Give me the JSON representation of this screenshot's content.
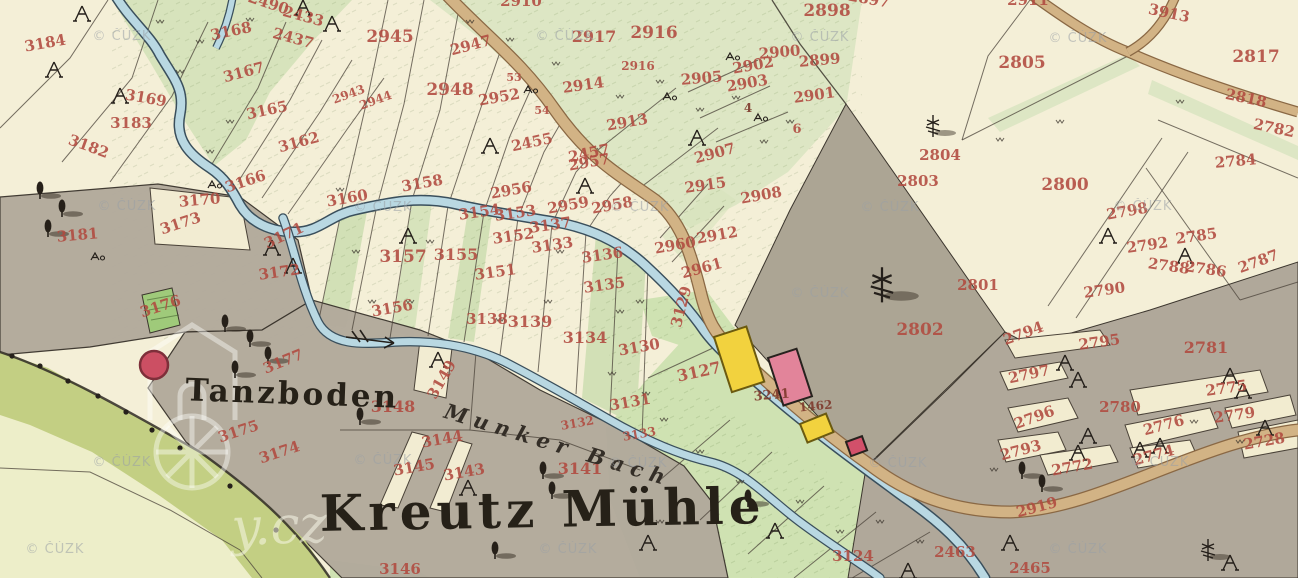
{
  "map": {
    "type": "historical-cadastral-map",
    "place_labels": {
      "settlement": "Kreutz Mühle",
      "area": "Tanzboden",
      "stream": "Munker Bach"
    },
    "watermark_text": "© ČÚZK",
    "watermark_big_text": "y.cz",
    "palette": {
      "paper": "#f4efd7",
      "field_green": "#d7e3bc",
      "meadow_olive": "#c3cf83",
      "pasture_gray": "#b2aa9c",
      "water_fill": "#b9d8e2",
      "water_edge": "#3a4f5c",
      "road_fill": "#d2b385",
      "road_edge": "#8a6844",
      "parcel_number_red": "#b14a3f",
      "building_wood_yellow": "#f2d23e",
      "building_masonry_pink": "#e2849a",
      "building_red": "#d2506a",
      "label_black": "#262118"
    },
    "parcel_numbers": [
      [
        "3184",
        46,
        48,
        -10
      ],
      [
        "3183",
        131,
        128,
        0
      ],
      [
        "3182",
        87,
        151,
        20
      ],
      [
        "3169",
        145,
        103,
        10
      ],
      [
        "3168",
        232,
        36,
        -12
      ],
      [
        "3167",
        245,
        77,
        -15
      ],
      [
        "3165",
        268,
        115,
        -12
      ],
      [
        "3162",
        300,
        147,
        -15
      ],
      [
        "3166",
        247,
        186,
        -18
      ],
      [
        "3170",
        200,
        205,
        -5
      ],
      [
        "3173",
        182,
        228,
        -18
      ],
      [
        "3181",
        78,
        240,
        -5
      ],
      [
        "3171",
        286,
        240,
        -25
      ],
      [
        "3172",
        280,
        277,
        -8
      ],
      [
        "3176",
        162,
        311,
        -18
      ],
      [
        "3177",
        285,
        366,
        -22
      ],
      [
        "3175",
        240,
        436,
        -18
      ],
      [
        "3174",
        281,
        457,
        -18
      ],
      [
        "2490",
        267,
        8,
        18
      ],
      [
        "2433",
        302,
        21,
        15
      ],
      [
        "2437",
        292,
        43,
        15
      ],
      [
        "2945",
        390,
        42,
        0,
        17
      ],
      [
        "2947",
        472,
        50,
        -15
      ],
      [
        "2948",
        450,
        95,
        0,
        17
      ],
      [
        "2952",
        500,
        102,
        -10
      ],
      [
        "53",
        514,
        81,
        0,
        11
      ],
      [
        "54",
        542,
        114,
        0,
        11
      ],
      [
        "2943",
        350,
        98,
        -20,
        12
      ],
      [
        "2944",
        377,
        104,
        -20,
        12
      ],
      [
        "2455",
        533,
        147,
        -12
      ],
      [
        "2457",
        590,
        158,
        -12
      ],
      [
        "2910",
        521,
        6,
        0
      ],
      [
        "2914",
        584,
        90,
        -8
      ],
      [
        "2913",
        628,
        127,
        -10
      ],
      [
        "2916",
        654,
        38,
        0,
        17
      ],
      [
        "2916",
        638,
        70,
        0,
        12
      ],
      [
        "2917",
        594,
        42,
        0,
        16
      ],
      [
        "2898",
        827,
        16,
        0,
        17
      ],
      [
        "2899",
        820,
        65,
        -5
      ],
      [
        "2900",
        780,
        57,
        -5
      ],
      [
        "2901",
        815,
        100,
        -8
      ],
      [
        "2902",
        754,
        70,
        -10
      ],
      [
        "2903",
        748,
        88,
        -10
      ],
      [
        "2905",
        702,
        83,
        -5
      ],
      [
        "2897",
        868,
        4,
        10
      ],
      [
        "2907",
        716,
        158,
        -15
      ],
      [
        "2915",
        706,
        190,
        -8
      ],
      [
        "2908",
        762,
        200,
        -10
      ],
      [
        "2912",
        718,
        240,
        -10
      ],
      [
        "2960",
        676,
        250,
        -10
      ],
      [
        "2961",
        703,
        273,
        -15
      ],
      [
        "6",
        797,
        133,
        0,
        13
      ],
      [
        "2957",
        590,
        167,
        -10
      ],
      [
        "2956",
        512,
        195,
        -10
      ],
      [
        "2959",
        569,
        210,
        -10
      ],
      [
        "2958",
        613,
        210,
        -10
      ],
      [
        "3160",
        348,
        203,
        -10
      ],
      [
        "3158",
        423,
        188,
        -10
      ],
      [
        "3157",
        403,
        262,
        0,
        17
      ],
      [
        "3155",
        456,
        260,
        0,
        16
      ],
      [
        "3154",
        480,
        217,
        -8
      ],
      [
        "3153",
        516,
        218,
        -8
      ],
      [
        "3152",
        514,
        241,
        -8
      ],
      [
        "3151",
        496,
        277,
        -8
      ],
      [
        "3137",
        551,
        230,
        -8
      ],
      [
        "3133",
        553,
        250,
        -8
      ],
      [
        "3136",
        603,
        260,
        -8
      ],
      [
        "3135",
        605,
        290,
        -8
      ],
      [
        "3156",
        393,
        313,
        -10
      ],
      [
        "3138",
        487,
        324,
        0
      ],
      [
        "3139",
        530,
        327,
        0,
        16
      ],
      [
        "3134",
        585,
        343,
        0,
        16
      ],
      [
        "3130",
        640,
        352,
        -10
      ],
      [
        "3131",
        631,
        407,
        -10
      ],
      [
        "3132",
        578,
        427,
        -10,
        12
      ],
      [
        "3133",
        640,
        438,
        -10,
        12
      ],
      [
        "3129",
        686,
        308,
        -75
      ],
      [
        "3127",
        700,
        377,
        -12,
        16
      ],
      [
        "3149",
        446,
        382,
        -60
      ],
      [
        "3144",
        443,
        444,
        -10
      ],
      [
        "3145",
        415,
        472,
        -10
      ],
      [
        "3143",
        465,
        477,
        -10
      ],
      [
        "3141",
        580,
        474,
        0,
        16
      ],
      [
        "3148",
        393,
        412,
        0,
        16
      ],
      [
        "3146",
        400,
        574,
        0
      ],
      [
        "3124",
        853,
        561,
        0
      ],
      [
        "2463",
        955,
        557,
        0
      ],
      [
        "2465",
        1030,
        573,
        0
      ],
      [
        "2919",
        1038,
        512,
        -15
      ],
      [
        "2804",
        940,
        160,
        0
      ],
      [
        "2803",
        918,
        186,
        0
      ],
      [
        "2800",
        1065,
        190,
        0,
        17
      ],
      [
        "2801",
        978,
        290,
        0
      ],
      [
        "2802",
        920,
        335,
        0,
        17
      ],
      [
        "2805",
        1022,
        68,
        0,
        17
      ],
      [
        "3913",
        1168,
        18,
        12
      ],
      [
        "2911",
        1028,
        5,
        0
      ],
      [
        "2817",
        1256,
        62,
        0,
        17
      ],
      [
        "2818",
        1245,
        103,
        12
      ],
      [
        "2782",
        1273,
        133,
        12
      ],
      [
        "2784",
        1236,
        166,
        -5
      ],
      [
        "2798",
        1128,
        216,
        -10
      ],
      [
        "2792",
        1148,
        250,
        -8
      ],
      [
        "2785",
        1197,
        241,
        -8
      ],
      [
        "2788",
        1168,
        271,
        8
      ],
      [
        "2786",
        1205,
        274,
        8
      ],
      [
        "2787",
        1260,
        266,
        -20
      ],
      [
        "2790",
        1105,
        295,
        -8
      ],
      [
        "2781",
        1206,
        353,
        0,
        16
      ],
      [
        "2794",
        1025,
        338,
        -20
      ],
      [
        "2795",
        1100,
        347,
        -8
      ],
      [
        "2797",
        1030,
        379,
        -12
      ],
      [
        "2796",
        1036,
        422,
        -20
      ],
      [
        "2793",
        1022,
        455,
        -15
      ],
      [
        "2780",
        1120,
        412,
        0
      ],
      [
        "2775",
        1227,
        393,
        -8
      ],
      [
        "2776",
        1165,
        430,
        -15
      ],
      [
        "2779",
        1235,
        420,
        -8
      ],
      [
        "2728",
        1265,
        446,
        -10
      ],
      [
        "2772",
        1073,
        472,
        -10
      ],
      [
        "2774",
        1155,
        460,
        -15
      ]
    ],
    "house_numbers": [
      [
        "3241",
        772,
        399,
        -5,
        13
      ],
      [
        "1462",
        816,
        410,
        -5,
        12
      ],
      [
        "4",
        748,
        112,
        0,
        12
      ]
    ],
    "watermarks": [
      [
        122,
        40
      ],
      [
        565,
        40
      ],
      [
        820,
        41
      ],
      [
        1078,
        42
      ],
      [
        127,
        210
      ],
      [
        383,
        211
      ],
      [
        640,
        211
      ],
      [
        890,
        211
      ],
      [
        1143,
        210
      ],
      [
        820,
        297
      ],
      [
        122,
        466
      ],
      [
        383,
        464
      ],
      [
        638,
        467
      ],
      [
        898,
        467
      ],
      [
        1160,
        466
      ],
      [
        55,
        553
      ],
      [
        568,
        553
      ],
      [
        1078,
        553
      ]
    ],
    "buildings": [
      {
        "kind": "wood",
        "color": "#f2d23e",
        "outline": "#6b5a10",
        "x": 714,
        "y": 337,
        "w": 34,
        "h": 58,
        "rot": -18
      },
      {
        "kind": "masonry",
        "color": "#e2849a",
        "outline": "#27221e",
        "x": 768,
        "y": 358,
        "w": 30,
        "h": 50,
        "rot": -18
      },
      {
        "kind": "wood",
        "color": "#f2d23e",
        "outline": "#6b5a10",
        "x": 800,
        "y": 424,
        "w": 28,
        "h": 20,
        "rot": -22
      },
      {
        "kind": "masonry",
        "color": "#d2506a",
        "outline": "#27221e",
        "x": 846,
        "y": 442,
        "w": 17,
        "h": 15,
        "rot": -20
      }
    ],
    "dance_circle": {
      "cx": 154,
      "cy": 365,
      "r": 14,
      "color": "#cc4f63",
      "outline": "#7e2f3a"
    },
    "symbols": {
      "tents": [
        [
          82,
          16
        ],
        [
          54,
          72
        ],
        [
          120,
          98
        ],
        [
          303,
          10
        ],
        [
          332,
          26
        ],
        [
          272,
          250
        ],
        [
          293,
          268
        ],
        [
          408,
          238
        ],
        [
          490,
          148
        ],
        [
          585,
          188
        ],
        [
          697,
          140
        ],
        [
          438,
          362
        ],
        [
          468,
          490
        ],
        [
          775,
          533
        ],
        [
          1010,
          545
        ],
        [
          1078,
          455
        ],
        [
          1140,
          452
        ],
        [
          1108,
          238
        ],
        [
          1185,
          258
        ],
        [
          1065,
          365
        ],
        [
          1078,
          382
        ],
        [
          1230,
          378
        ],
        [
          1243,
          393
        ],
        [
          1088,
          438
        ],
        [
          1160,
          448
        ],
        [
          1265,
          430
        ],
        [
          1230,
          565
        ],
        [
          908,
          573
        ],
        [
          648,
          545
        ]
      ],
      "trees": [
        [
          40,
          192
        ],
        [
          62,
          210
        ],
        [
          48,
          230
        ],
        [
          225,
          325
        ],
        [
          250,
          340
        ],
        [
          268,
          357
        ],
        [
          235,
          371
        ],
        [
          360,
          418
        ],
        [
          543,
          472
        ],
        [
          552,
          492
        ],
        [
          495,
          552
        ],
        [
          1022,
          472
        ],
        [
          1042,
          485
        ],
        [
          748,
          500
        ]
      ],
      "pines": [
        [
          882,
          288,
          1.6
        ],
        [
          933,
          128,
          1
        ],
        [
          1208,
          552,
          1
        ]
      ],
      "meadow_marks": [
        [
          160,
          20
        ],
        [
          200,
          40
        ],
        [
          250,
          18
        ],
        [
          180,
          70
        ],
        [
          230,
          120
        ],
        [
          210,
          150
        ],
        [
          510,
          38
        ],
        [
          556,
          62
        ],
        [
          470,
          20
        ],
        [
          620,
          95
        ],
        [
          660,
          80
        ],
        [
          700,
          108
        ],
        [
          736,
          96
        ],
        [
          764,
          140
        ],
        [
          790,
          120
        ],
        [
          356,
          250
        ],
        [
          372,
          300
        ],
        [
          410,
          300
        ],
        [
          500,
          318
        ],
        [
          548,
          300
        ],
        [
          620,
          310
        ],
        [
          340,
          188
        ],
        [
          430,
          240
        ],
        [
          560,
          250
        ],
        [
          640,
          300
        ],
        [
          664,
          418
        ],
        [
          700,
          450
        ],
        [
          740,
          480
        ],
        [
          800,
          500
        ],
        [
          840,
          530
        ],
        [
          880,
          520
        ],
        [
          920,
          540
        ],
        [
          660,
          520
        ],
        [
          1000,
          138
        ],
        [
          1060,
          120
        ],
        [
          1180,
          100
        ],
        [
          994,
          468
        ],
        [
          1194,
          420
        ],
        [
          1240,
          440
        ],
        [
          612,
          372
        ],
        [
          646,
          392
        ]
      ],
      "a_marks": [
        [
          212,
          185
        ],
        [
          667,
          97
        ],
        [
          730,
          57
        ],
        [
          528,
          90
        ],
        [
          95,
          257
        ],
        [
          758,
          118
        ]
      ]
    }
  }
}
